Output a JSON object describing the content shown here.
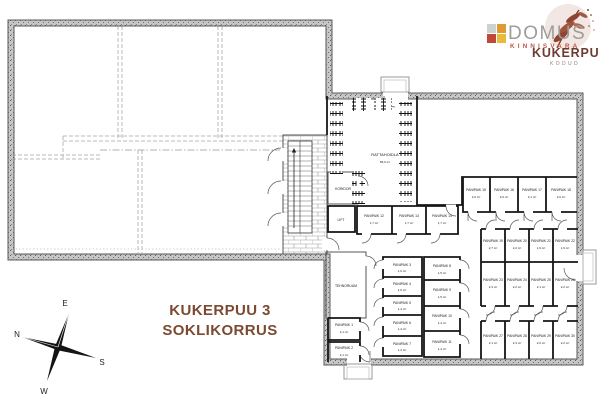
{
  "logo": {
    "brand": "DOMUS",
    "brand_sub": "KINNISVARA",
    "project": "KUKERPUU",
    "project_sub": "KODUD",
    "colors": {
      "square_pale": "#ccd2cf",
      "square_orange": "#de9a33",
      "square_red": "#bf4839",
      "square_yellow": "#e9bb3a",
      "brand_gray": "#9d9d99",
      "brand_red": "#c05848",
      "leaf_brown": "#7d3f2f",
      "leaf_bg": "#f3e7e3",
      "project_brown": "#713a2e"
    }
  },
  "title": {
    "line1": "KUKERPUU 3",
    "line2": "SOKLIKORRUS",
    "color": "#7b4a31"
  },
  "compass": {
    "north": "N",
    "east": "E",
    "south": "S",
    "west": "W"
  },
  "plan": {
    "rooms": [
      {
        "n": "RATTAHOIDLA",
        "a": "86,0 m²"
      },
      {
        "n": "KORIDOR",
        "a": ""
      },
      {
        "n": "LIFT",
        "a": ""
      },
      {
        "n": "TEHNORUUM",
        "a": ""
      },
      {
        "n": "PANIPAIK 1",
        "a": "2,1 m²"
      },
      {
        "n": "PANIPAIK 2",
        "a": "2,1 m²"
      },
      {
        "n": "PANIPAIK 3",
        "a": "1,6 m²"
      },
      {
        "n": "PANIPAIK 4",
        "a": "1,6 m²"
      },
      {
        "n": "PANIPAIK 5",
        "a": "1,4 m²"
      },
      {
        "n": "PANIPAIK 6",
        "a": "1,4 m²"
      },
      {
        "n": "PANIPAIK 7",
        "a": "1,4 m²"
      },
      {
        "n": "PANIPAIK 8",
        "a": "1,5 m²"
      },
      {
        "n": "PANIPAIK 9",
        "a": "1,5 m²"
      },
      {
        "n": "PANIPAIK 10",
        "a": "1,4 m²"
      },
      {
        "n": "PANIPAIK 11",
        "a": "1,4 m²"
      },
      {
        "n": "PANIPAIK 12",
        "a": "1,7 m²"
      },
      {
        "n": "PANIPAIK 13",
        "a": "1,7 m²"
      },
      {
        "n": "PANIPAIK 14",
        "a": "1,7 m²"
      },
      {
        "n": "PANIPAIK 15",
        "a": "2,6 m²"
      },
      {
        "n": "PANIPAIK 16",
        "a": "2,6 m²"
      },
      {
        "n": "PANIPAIK 17",
        "a": "2,1 m²"
      },
      {
        "n": "PANIPAIK 18",
        "a": "2,6 m²"
      },
      {
        "n": "PANIPAIK 19",
        "a": "2,7 m²"
      },
      {
        "n": "PANIPAIK 20",
        "a": "2,2 m²"
      },
      {
        "n": "PANIPAIK 21",
        "a": "1,9 m²"
      },
      {
        "n": "PANIPAIK 22",
        "a": "1,9 m²"
      },
      {
        "n": "PANIPAIK 23",
        "a": "2,3 m²"
      },
      {
        "n": "PANIPAIK 24",
        "a": "2,2 m²"
      },
      {
        "n": "PANIPAIK 25",
        "a": "2,1 m²"
      },
      {
        "n": "PANIPAIK 26",
        "a": "2,2 m²"
      },
      {
        "n": "PANIPAIK 27",
        "a": "2,1 m²"
      },
      {
        "n": "PANIPAIK 28",
        "a": "2,3 m²"
      },
      {
        "n": "PANIPAIK 29",
        "a": "2,0 m²"
      },
      {
        "n": "PANIPAIK 30",
        "a": "2,2 m²"
      }
    ]
  }
}
